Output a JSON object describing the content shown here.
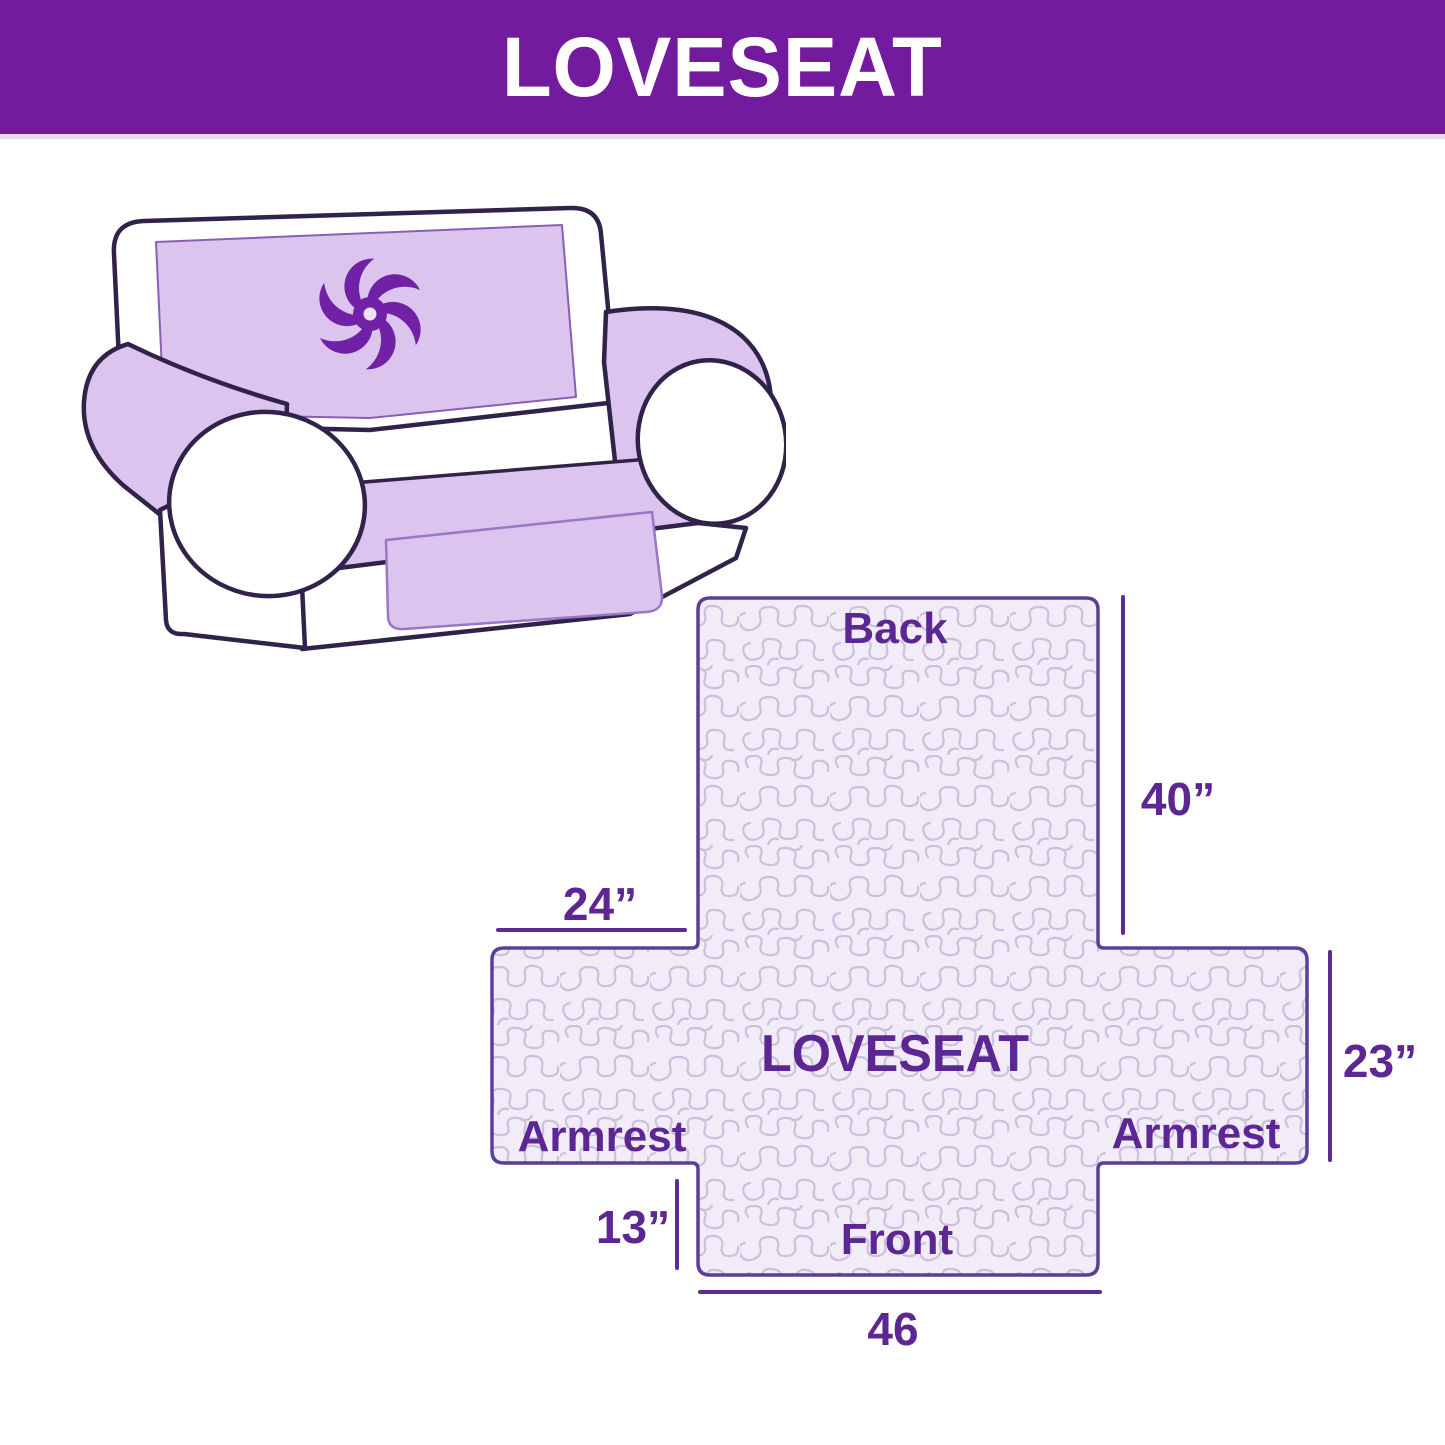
{
  "header": {
    "title": "LOVESEAT"
  },
  "colors": {
    "header_bg": "#731B9E",
    "label_text": "#5C2693",
    "diagram_outline": "#5B3E98",
    "dimension_line": "#5C2D91",
    "cover_lavender": "#DBC5EE",
    "quilt_background": "#F1ECF7",
    "quilt_squiggle": "#CCC1DC",
    "sofa_outline": "#31224A",
    "pinwheel_purple": "#7121A5"
  },
  "illustration": {
    "description": "Two-seat loveseat sofa wearing a lavender quilted protector cover",
    "logo_icon": "pinwheel"
  },
  "diagram": {
    "product_label": "LOVESEAT",
    "section_labels": {
      "back": "Back",
      "front": "Front",
      "armrest_left": "Armrest",
      "armrest_right": "Armrest"
    },
    "dimensions": {
      "back_height": "40”",
      "armrest_top_width": "24”",
      "armrest_side_height": "23”",
      "front_skirt_drop": "13”",
      "front_width": "46"
    }
  }
}
